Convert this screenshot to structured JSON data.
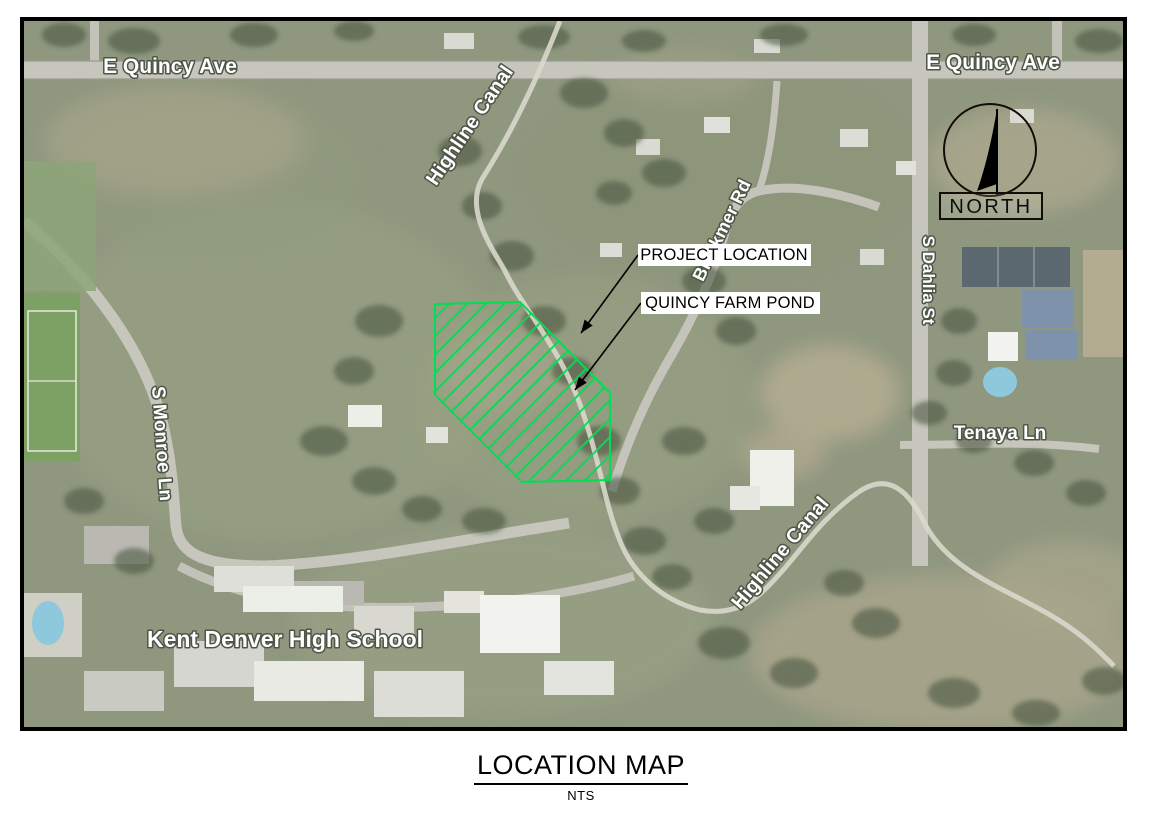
{
  "title_block": {
    "title": "LOCATION MAP",
    "scale": "NTS"
  },
  "map": {
    "street_labels": {
      "quincy_left": "E Quincy Ave",
      "quincy_right": "E Quincy Ave",
      "highline_canal_top": "Highline Canal",
      "highline_canal_bottom": "Highline Canal",
      "monroe": "S Monroe Ln",
      "dahlia": "S Dahlia St",
      "blackmer": "Blackmer Rd",
      "tenaya": "Tenaya Ln"
    },
    "place_labels": {
      "school": "Kent Denver High School"
    },
    "callouts": {
      "project_location": "PROJECT LOCATION",
      "quincy_farm_pond": "QUINCY FARM POND"
    },
    "compass": {
      "label": "NORTH"
    },
    "colors": {
      "project_hatch_green": "#00DE52",
      "callout_background": "#FFFFFF",
      "callout_text": "#000000",
      "frame_border": "#000000"
    }
  }
}
